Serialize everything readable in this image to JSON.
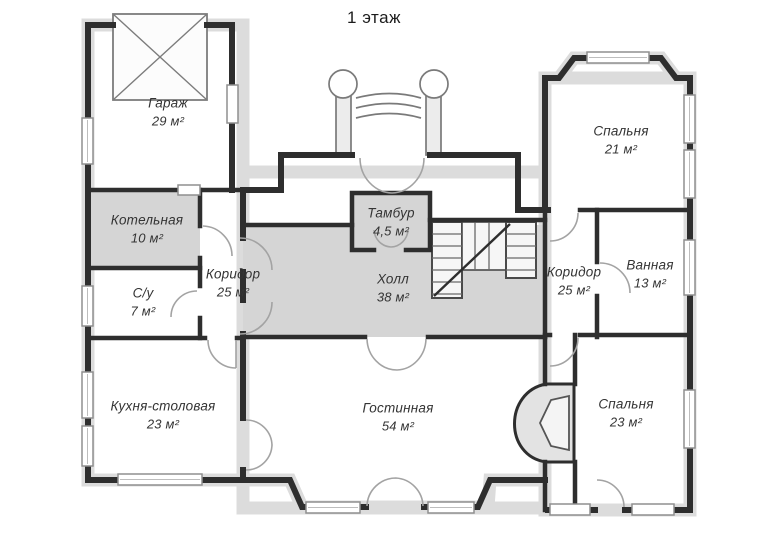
{
  "title": "1 этаж",
  "plan": {
    "rooms": [
      {
        "id": "garage",
        "name": "Гараж",
        "area": "29 м²"
      },
      {
        "id": "boiler",
        "name": "Котельная",
        "area": "10 м²"
      },
      {
        "id": "wc",
        "name": "С/у",
        "area": "7 м²"
      },
      {
        "id": "corridor-left",
        "name": "Коридор",
        "area": "25 м²"
      },
      {
        "id": "tambour",
        "name": "Тамбур",
        "area": "4,5 м²"
      },
      {
        "id": "hall",
        "name": "Холл",
        "area": "38 м²"
      },
      {
        "id": "corridor-right",
        "name": "Коридор",
        "area": "25 м²"
      },
      {
        "id": "bath",
        "name": "Ванная",
        "area": "13 м²"
      },
      {
        "id": "bedroom-top-right",
        "name": "Спальня",
        "area": "21 м²"
      },
      {
        "id": "kitchen",
        "name": "Кухня-столовая",
        "area": "23 м²"
      },
      {
        "id": "living",
        "name": "Гостинная",
        "area": "54 м²"
      },
      {
        "id": "bedroom-bottom-right",
        "name": "Спальня",
        "area": "23 м²"
      }
    ],
    "colors": {
      "wall": "#2e2e2e",
      "shaded_room": "#d5d5d5",
      "exterior_band": "#dcdcdc",
      "paper": "#ffffff"
    }
  }
}
